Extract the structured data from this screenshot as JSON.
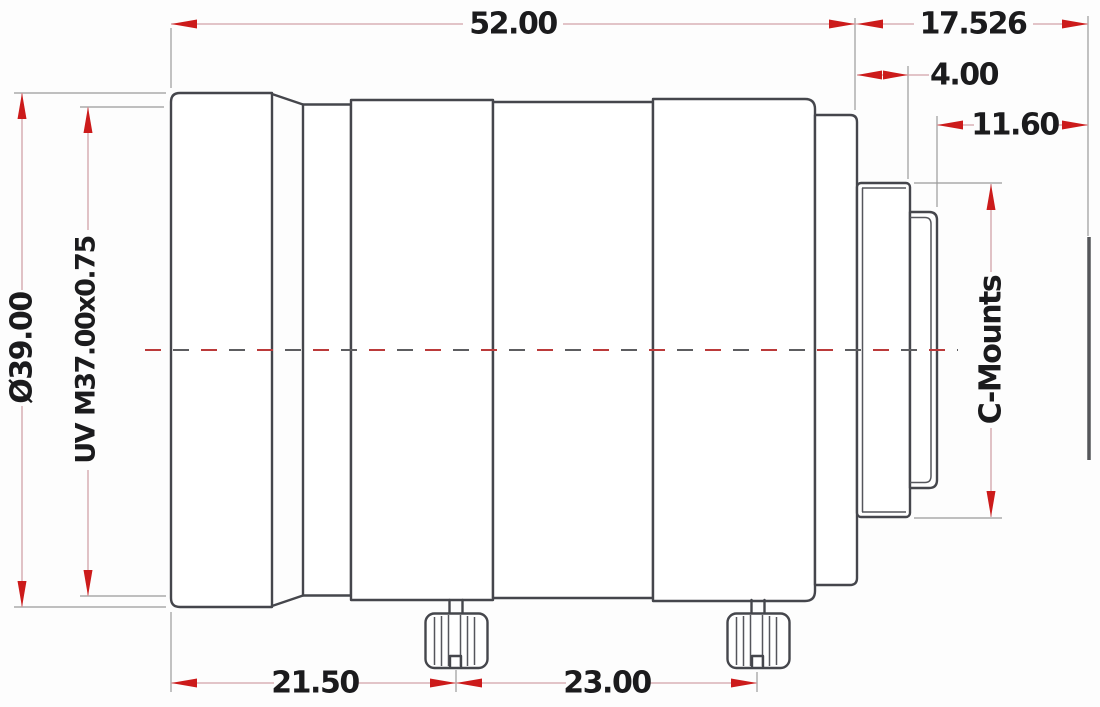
{
  "drawing": {
    "type": "engineering-dimension-drawing",
    "subject": "C-mount machine-vision lens, side elevation with dimensions (mm)",
    "dimensions": {
      "overall_length": "52.00",
      "flange_back_distance": "17.526",
      "rear_flange_thickness": "4.00",
      "mount_thread_length": "11.60",
      "front_diameter": "Ø39.00",
      "front_filter_thread": "UV M37.00x0.75",
      "mount_type_label": "C-Mounts",
      "front_to_focus_knob": "21.50",
      "knob_to_knob_spacing": "23.00"
    },
    "colors": {
      "outline": "#45464c",
      "dimension_arrow": "#cc1b1b",
      "dimension_line": "#d2a3a8",
      "extension_line": "#9a9a9a",
      "centerline_red": "#bb3a3a",
      "background": "#fdfdfd"
    }
  }
}
